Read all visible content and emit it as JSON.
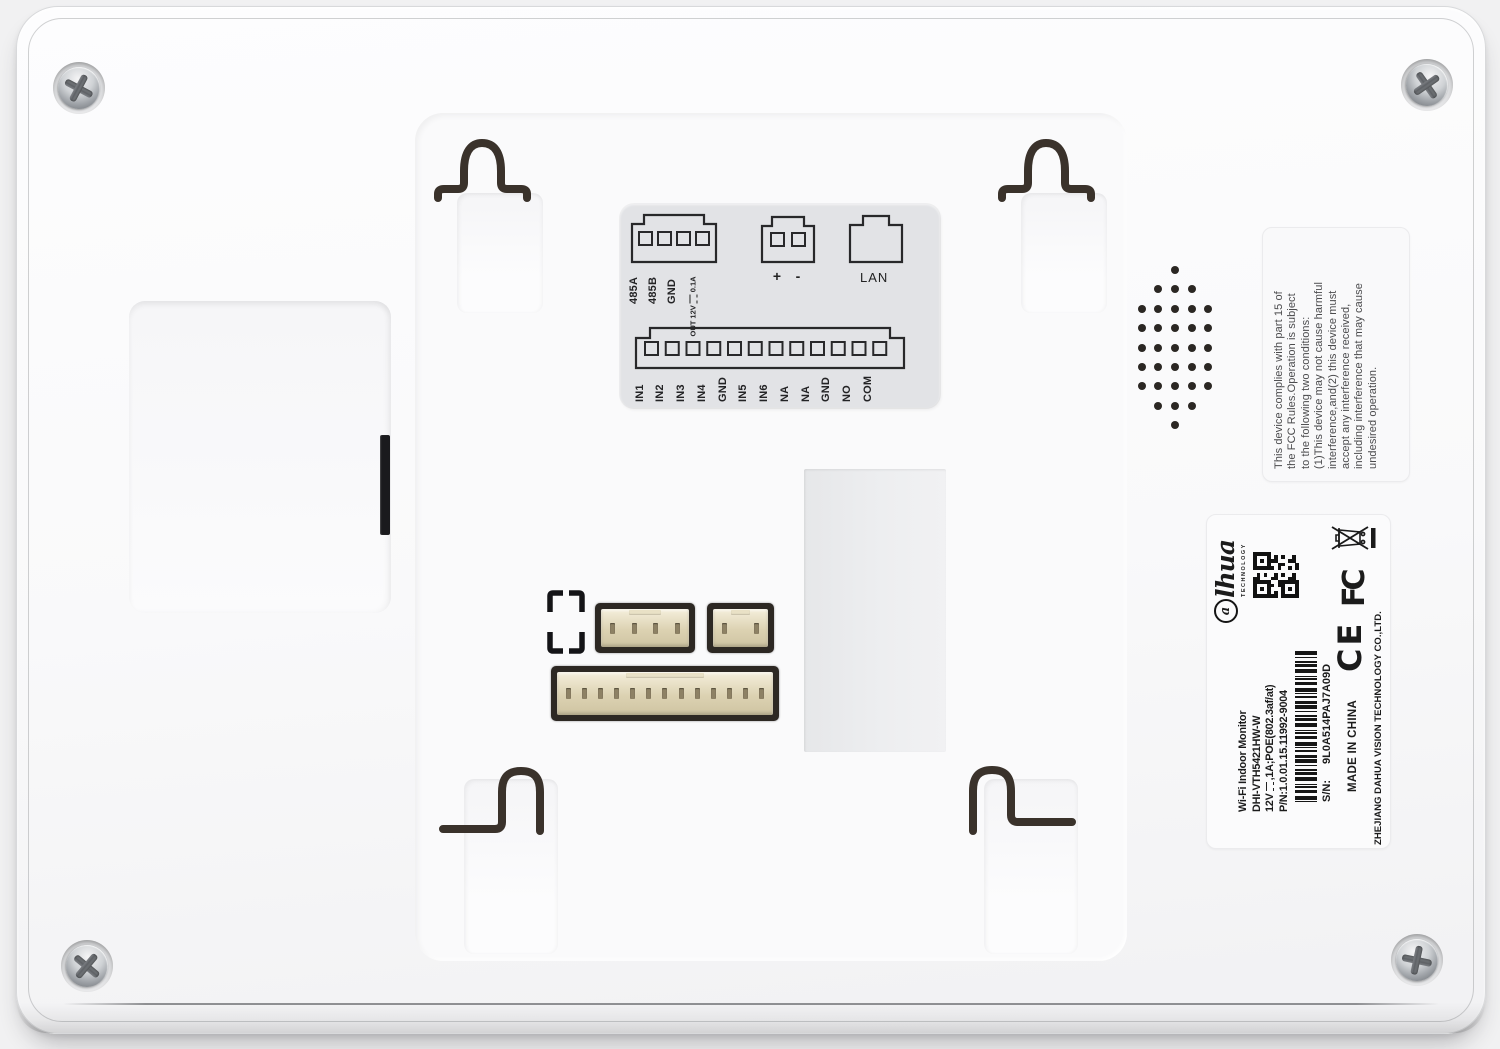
{
  "plate": {
    "rs485_pins": [
      "485A",
      "485B",
      "GND"
    ],
    "out_prefix": "OUT 12V",
    "out_suffix": "0.1A",
    "power_pins": [
      "+",
      "-"
    ],
    "lan_label": "LAN",
    "io_pins": [
      "IN1",
      "IN2",
      "IN3",
      "IN4",
      "GND",
      "IN5",
      "IN6",
      "NA",
      "NA",
      "GND",
      "NO",
      "COM"
    ]
  },
  "fcc": {
    "lines": [
      "This device complies with part 15 of",
      "the FCC Rules.Operation is subject",
      "to the following two conditions:",
      "(1)This device may not cause harmful",
      "interference,and(2) this device must",
      "accept any interference received,",
      "including interference that may cause",
      "undesired operation."
    ]
  },
  "label": {
    "brand_a": "a",
    "brand_rest": "lhua",
    "brand_sub": "TECHNOLOGY",
    "product": "Wi-Fi Indoor Monitor",
    "model": "DHI-VTH5421HW-W",
    "power_prefix": "12V",
    "power_suffix": ",1A;POE(802.3af/at)",
    "pn": "P/N:1.0.01.15.11992-9004",
    "sn_label": "S/N:",
    "sn": "9L0A514PAJ7A09D",
    "made_in": "MADE IN CHINA",
    "company": "ZHEJIANG DAHUA VISION TECHNOLOGY CO.,LTD.",
    "ce_mark": "CE",
    "fcc_mark": "FC"
  },
  "speaker": {
    "rows": [
      1,
      3,
      5,
      5,
      5,
      5,
      5,
      3,
      1
    ]
  },
  "colors": {
    "background": "#f1f1f2",
    "device_white": "#fbfbfc",
    "plate_gray": "#e2e3e6",
    "line_art": "#28282a",
    "slot_dark": "#1a1a1d",
    "hook_dark": "#3a322b",
    "connector_beige": "#dcd2b2",
    "dot_dark": "#2b2723"
  }
}
